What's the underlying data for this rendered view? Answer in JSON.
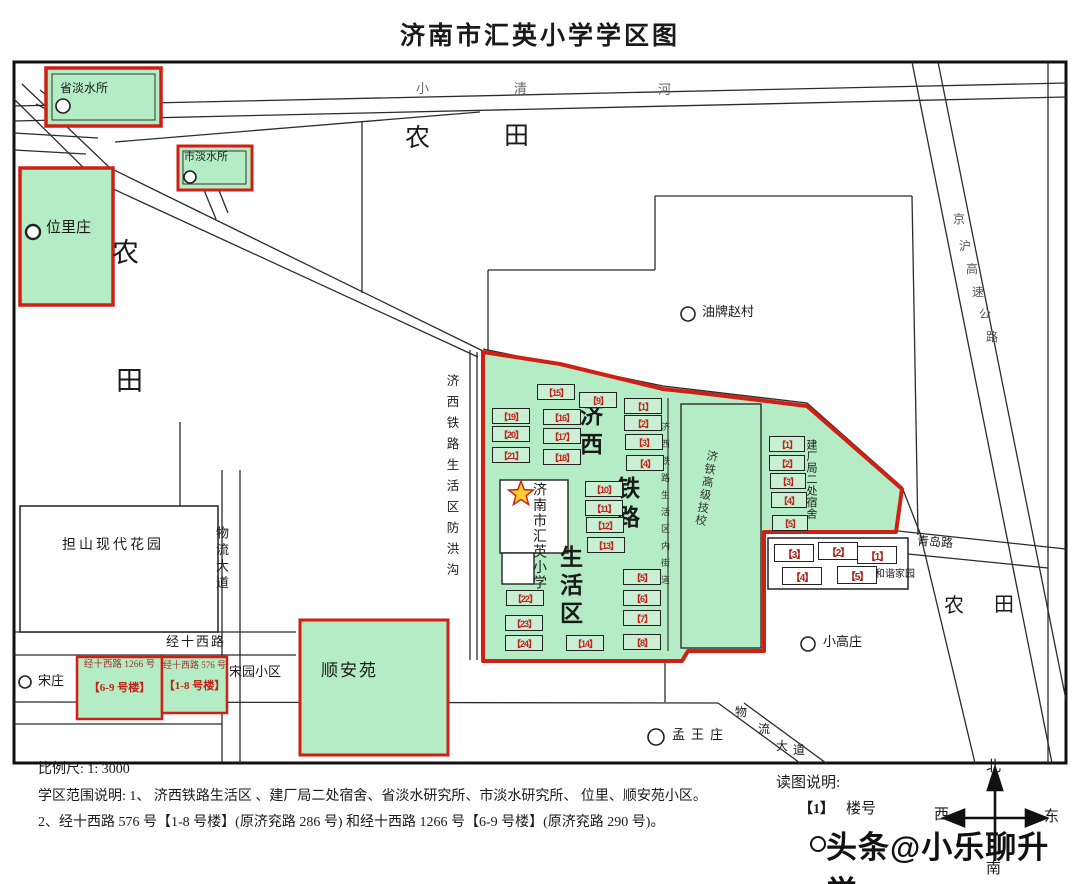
{
  "title": "济南市汇英小学学区图",
  "colors": {
    "district_fill": "#b4edc5",
    "boundary_red": "#cf2015",
    "building_number_red": "#c32218"
  },
  "labels": {
    "provincial_freshwater_institute": "省淡水所",
    "city_freshwater_institute": "市淡水所",
    "weilizhuang": "位里庄",
    "youpai_zhaocun": "油牌赵村",
    "danshan_modern_garden": "担山现代花园",
    "songzhuang": "宋庄",
    "songyuan_community": "宋园小区",
    "shunanyuan": "顺安苑",
    "xiaogaozhuang": "小高庄",
    "mengwangzhuang": "孟王庄",
    "hexie_jiayuan": "和谐家园",
    "jitie_technical_school": "济铁高级技校",
    "school_name": "济南市汇英小学",
    "jianchangju_dormitory": "建厂局二处宿舍",
    "jixi_area": "济西铁路生活区",
    "inner_street": "济西铁路生活区内街道",
    "flood_ditch": "济西铁路生活区防洪沟",
    "farmland": "农田",
    "jingshixi_1266": {
      "line1": "经十西路 1266 号",
      "line2": "【6-9 号楼】"
    },
    "jingshixi_576": {
      "line1": "经十西路 576 号",
      "line2": "【1-8 号楼】"
    }
  },
  "roads": {
    "xiaoqing_river": "小清河",
    "jinghu_expressway": "京沪高速公路",
    "jingshixi_road": "经十西路",
    "wuliu_avenue": "物流大道",
    "qingdao_road": "青岛路"
  },
  "buildings": {
    "district": [
      "【15】",
      "【9】",
      "【1】",
      "【19】",
      "【16】",
      "【2】",
      "【20】",
      "【17】",
      "【3】",
      "【21】",
      "【18】",
      "【4】",
      "【10】",
      "【11】",
      "【12】",
      "【13】",
      "【5】",
      "【6】",
      "【7】",
      "【8】",
      "【22】",
      "【23】",
      "【24】",
      "【14】"
    ],
    "dormitory": [
      "【1】",
      "【2】",
      "【3】",
      "【4】",
      "【5】"
    ],
    "harmony": [
      "【3】",
      "【2】",
      "【1】",
      "【4】",
      "【5】"
    ]
  },
  "notes": {
    "scale": "比例尺: 1: 3000",
    "line1": "学区范围说明: 1、 济西铁路生活区 、建厂局二处宿舍、省淡水研究所、市淡水研究所、 位里、顺安苑小区。",
    "line2": "2、经十西路 576 号【1-8 号楼】(原济兖路 286 号) 和经十西路 1266 号【6-9 号楼】(原济兖路 290 号)。",
    "legend_title": "读图说明:",
    "legend_num": "【1】",
    "legend_text": "楼号"
  },
  "compass": {
    "north": "北",
    "south": "南",
    "east": "东",
    "west": "西"
  },
  "watermark": "头条@小乐聊升学"
}
